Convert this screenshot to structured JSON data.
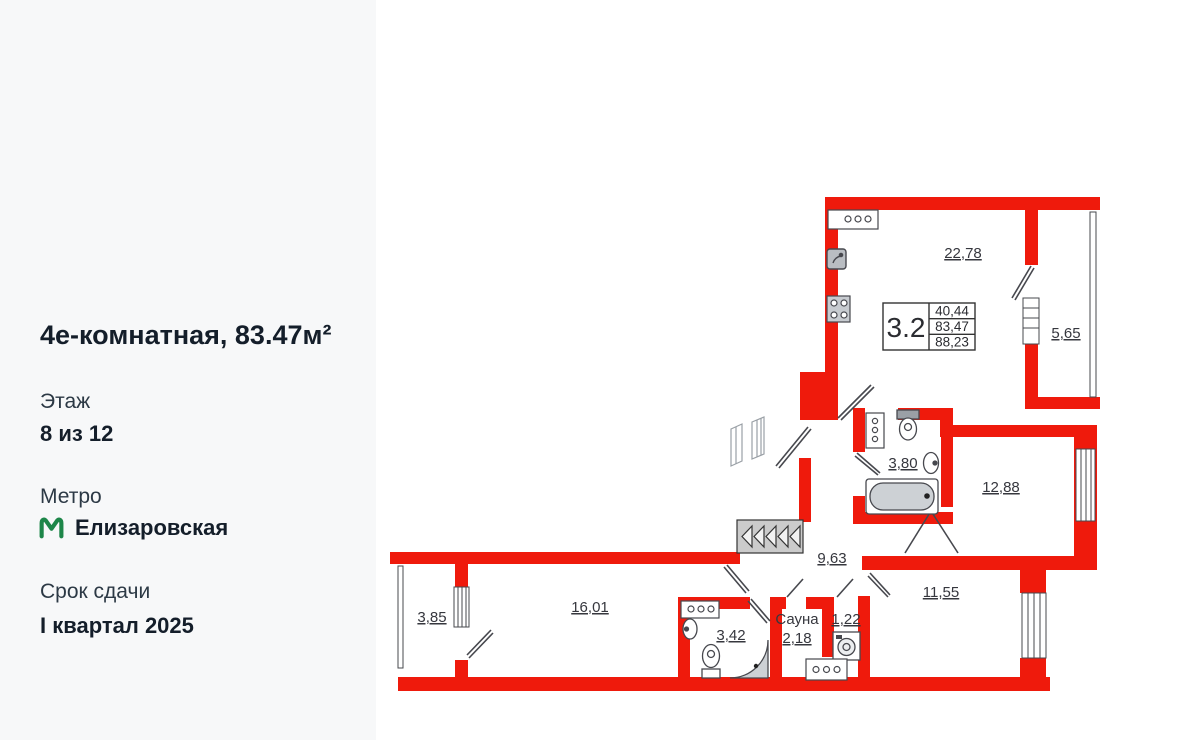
{
  "sidebar": {
    "title": "4е-комнатная, 83.47м²",
    "floor_label": "Этаж",
    "floor_value": "8 из 12",
    "metro_label": "Метро",
    "metro_station": "Елизаровская",
    "deadline_label": "Срок сдачи",
    "deadline_value": "I квартал 2025"
  },
  "plan": {
    "unit_table": {
      "number": "3.2",
      "row1": "40,44",
      "row2": "83,47",
      "row3": "88,23"
    },
    "labels": {
      "living": "22,78",
      "balcony_top": "5,65",
      "bath_top": "3,80",
      "bedroom_right": "12,88",
      "hall": "9,63",
      "bedroom_bottom_right": "11,55",
      "bedroom_bottom_left": "16,01",
      "balcony_bottom": "3,85",
      "bath_bottom": "3,42",
      "sauna_name": "Сауна",
      "sauna_area": "2,18",
      "closet": "1,22"
    },
    "colors": {
      "wall_red": "#ef1a0c",
      "line_dark": "#47484e",
      "sidebar_bg": "#f7f8f9",
      "metro_green": "#1d8649",
      "label_text": "#36373e"
    }
  }
}
